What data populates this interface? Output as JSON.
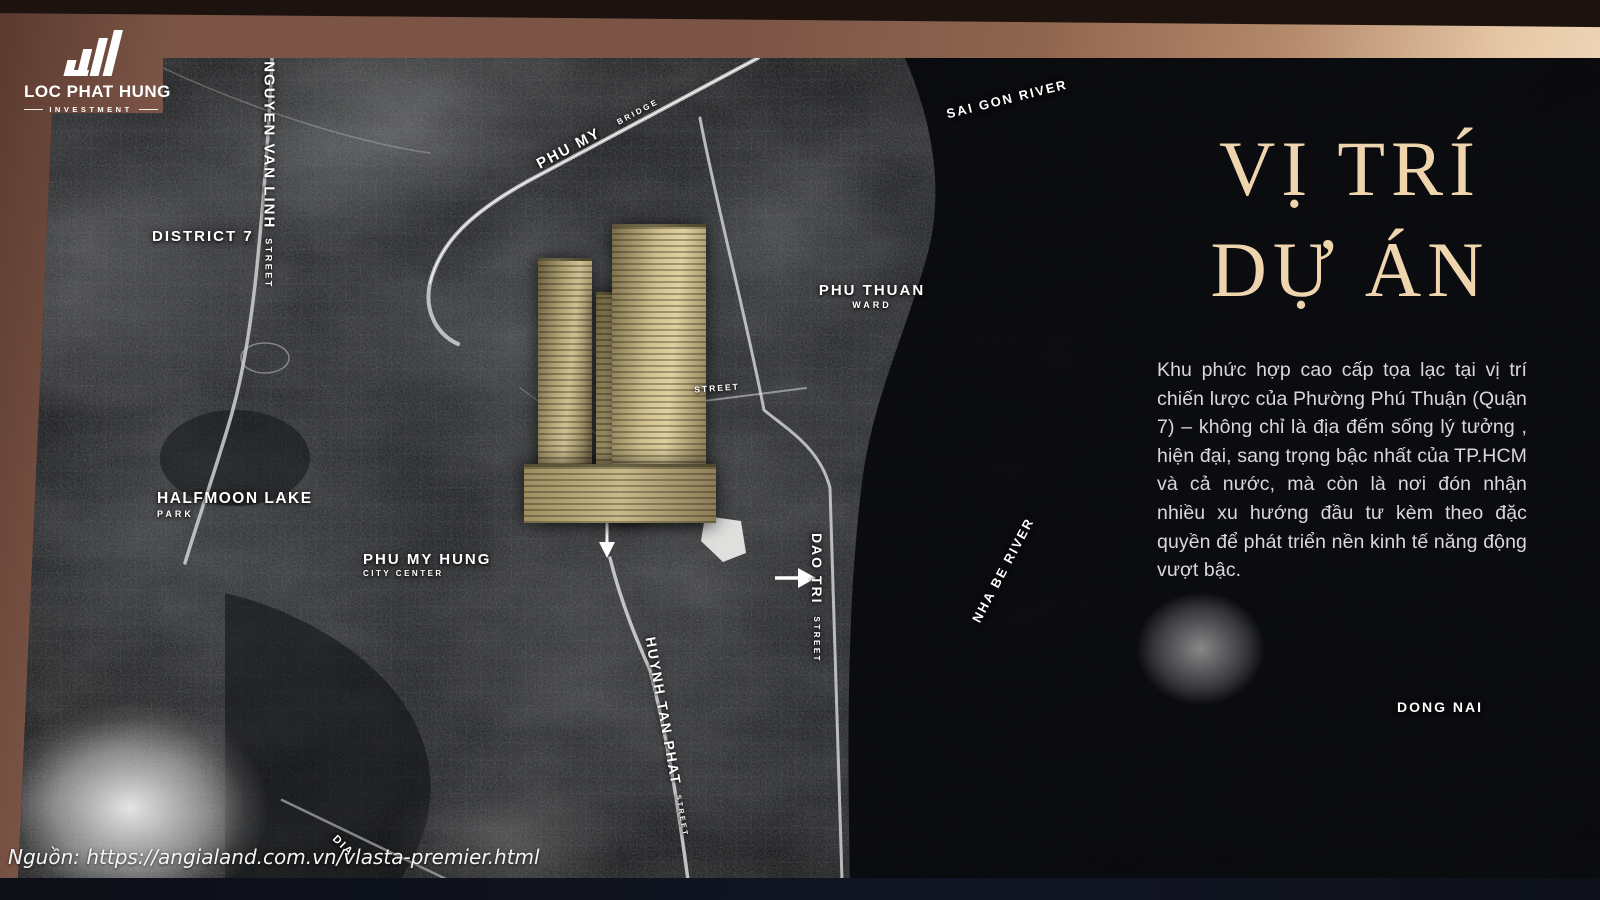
{
  "branding": {
    "company": "LOC PHAT HUNG",
    "division": "INVESTMENT"
  },
  "panel": {
    "title_line1": "VỊ TRÍ",
    "title_line2": "DỰ ÁN",
    "description": "Khu phức hợp cao cấp tọa lạc tại vị trí chiến lược của Phường Phú Thuận (Quận 7) – không chỉ là địa đếm sống lý tưởng , hiện đại, sang trọng bậc nhất của TP.HCM và cả nước, mà còn là nơi đón nhận nhiều xu hướng đầu tư kèm theo đặc quyền để phát triển nền kinh tế năng động vượt bậc."
  },
  "source": {
    "text": "Nguồn: https://angialand.com.vn/vlasta-premier.html"
  },
  "map": {
    "labels": [
      {
        "name": "DISTRICT 7",
        "sub": ""
      },
      {
        "name": "NGUYEN VAN LINH",
        "sub": "STREET"
      },
      {
        "name": "PHU MY",
        "sub": "BRIDGE"
      },
      {
        "name": "SAI GON RIVER",
        "sub": ""
      },
      {
        "name": "PHU THUAN",
        "sub": "WARD"
      },
      {
        "name": "HALFMOON LAKE",
        "sub": "PARK"
      },
      {
        "name": "PHU MY HUNG",
        "sub": "CITY CENTER"
      },
      {
        "name": "STREET",
        "sub": ""
      },
      {
        "name": "DAO TRI",
        "sub": "STREET"
      },
      {
        "name": "NHA BE RIVER",
        "sub": ""
      },
      {
        "name": "HUYNH TAN PHAT",
        "sub": "STREET"
      },
      {
        "name": "DIA",
        "sub": ""
      },
      {
        "name": "DONG NAI",
        "sub": ""
      }
    ]
  },
  "colors": {
    "frame_brown": "#7b5446",
    "frame_cream": "#f4e1c5",
    "title_text": "#efd5ae",
    "body_text": "#d8d8d8",
    "label_text": "#ffffff",
    "tower_gold": "#c9b98a",
    "map_base": "#17191c"
  }
}
